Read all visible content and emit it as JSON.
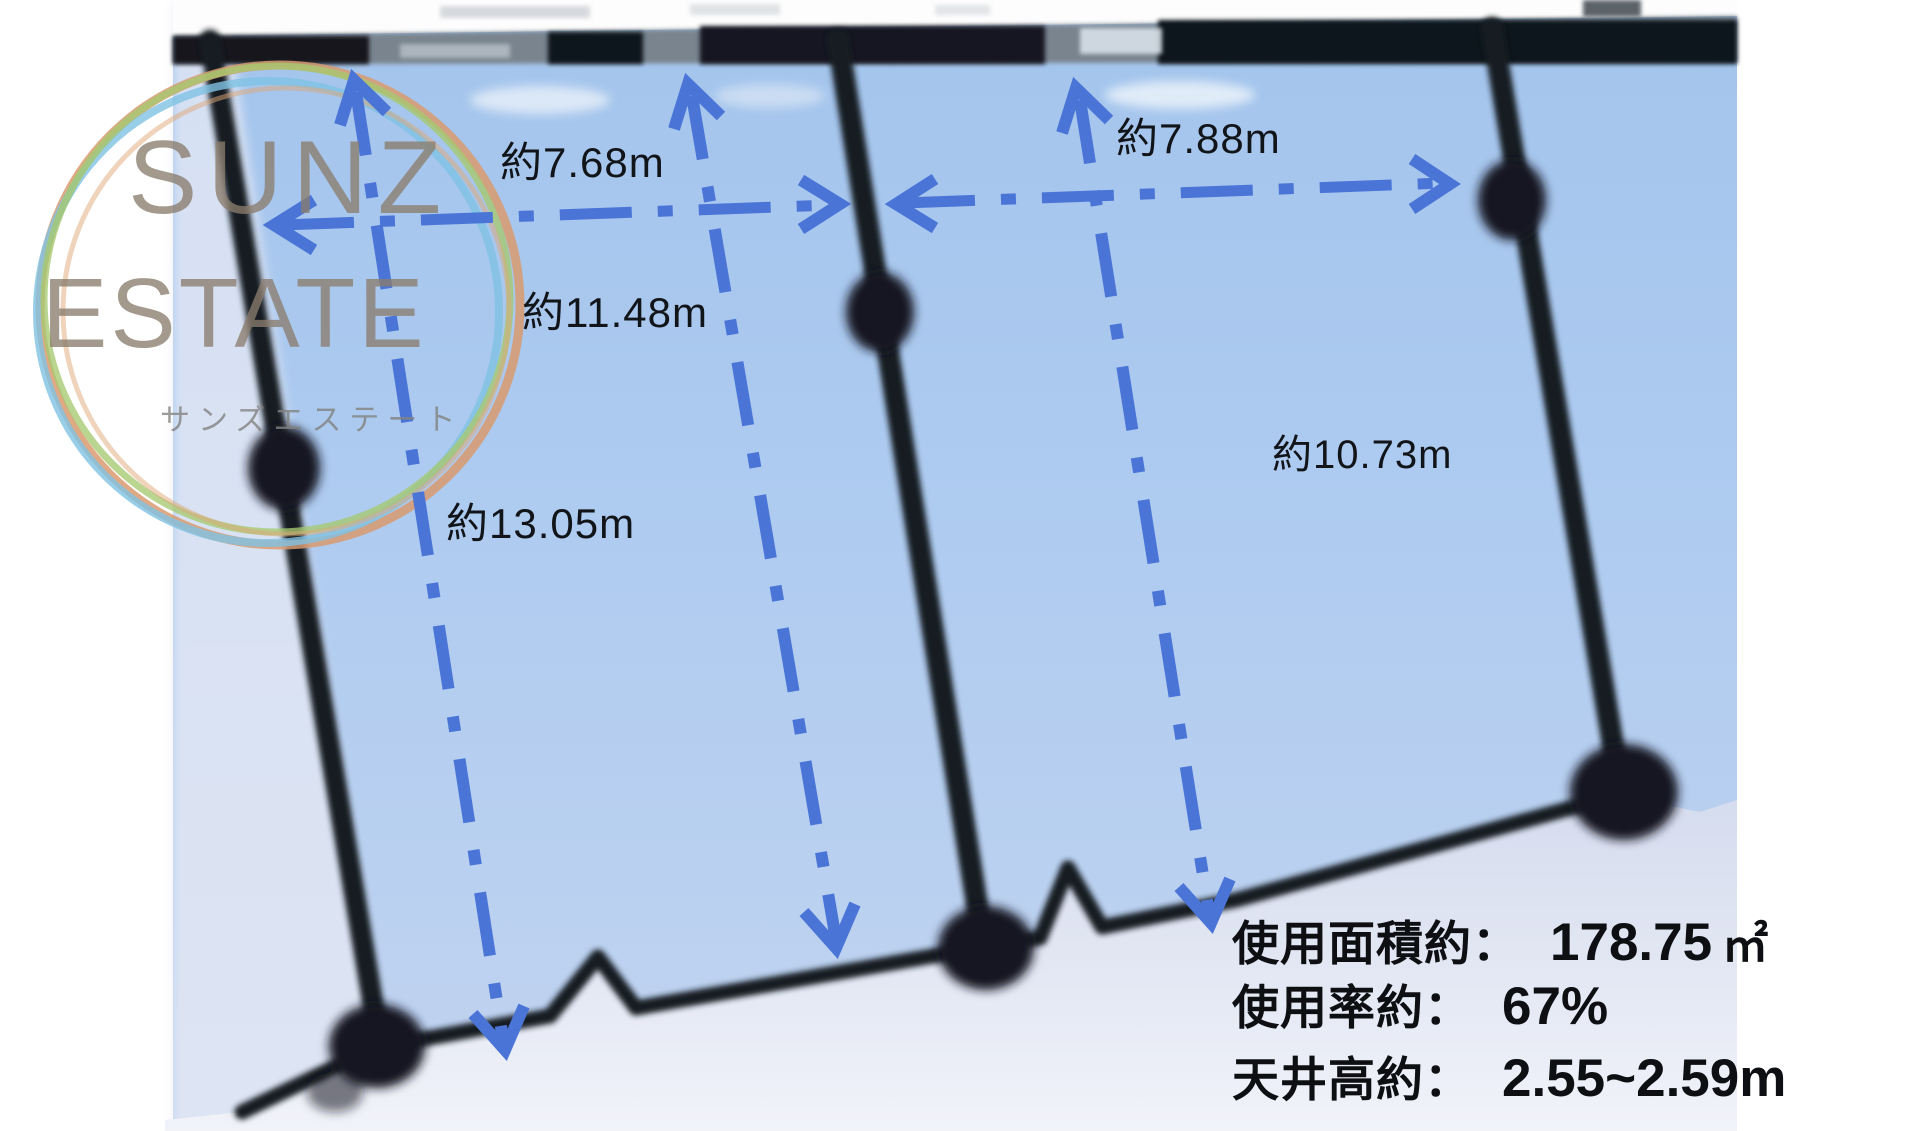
{
  "watermark": {
    "line1": "SUNZ",
    "line2": "ESTATE",
    "subtitle": "サンズエステート"
  },
  "measurements": {
    "bay_left_width": "約7.68m",
    "bay_right_width": "約7.88m",
    "left_depth": "約13.05m",
    "middle_depth": "約11.48m",
    "right_depth": "約10.73m"
  },
  "summary": {
    "area": {
      "label": "使用面積約：",
      "value": "178.75",
      "unit": "㎡"
    },
    "ratio": {
      "label": "使用率約：",
      "value": "67%"
    },
    "ceiling": {
      "label": "天井高約：",
      "value": "2.55~2.59m"
    }
  },
  "colors": {
    "annotation_blue": "#4a75d7",
    "structure_dark": "#161b21",
    "photo_light_blue": "#abc9ef",
    "photo_pale": "#e2e6f3",
    "logo_ring_orange": "#d89a6e",
    "logo_ring_sky": "#7fc2e4",
    "logo_ring_green": "#a5c96f",
    "logo_text": "#8a7c6d"
  }
}
